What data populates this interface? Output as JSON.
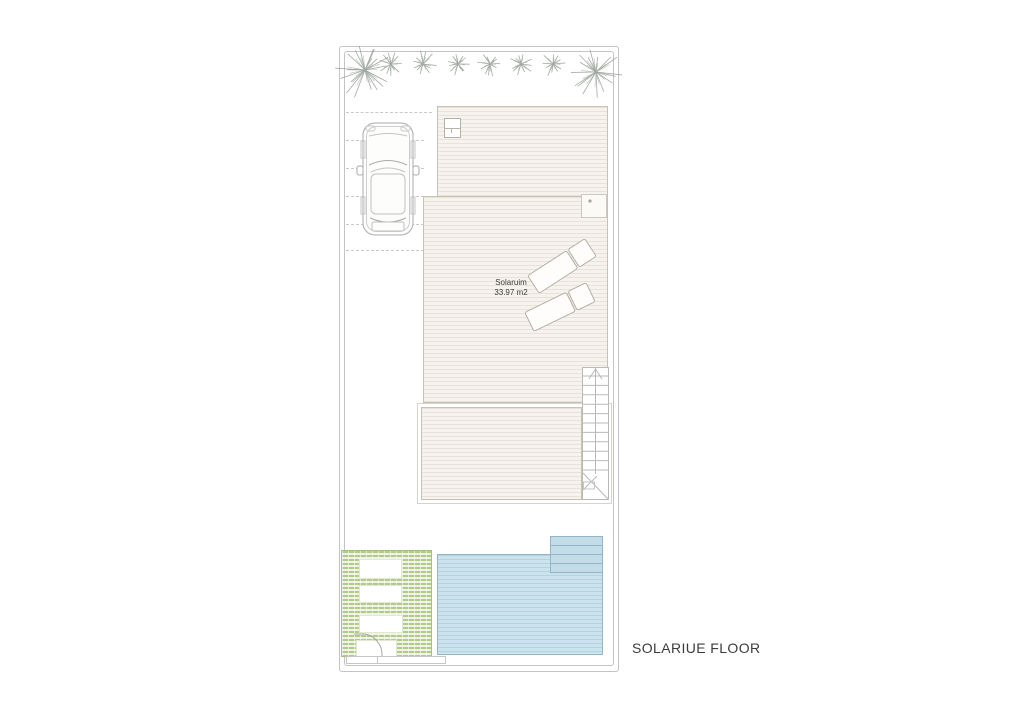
{
  "plan": {
    "floor_label": "SOLARIUE FLOOR",
    "solarium_label": {
      "line1": "Solaruim",
      "line2": "33.97 m2"
    }
  },
  "theme": {
    "boundary": "#c4c4c4",
    "wall": "#c6c2b8",
    "deck_fill": "#f6f3ee",
    "deck_line": "#e8e3d8",
    "pool_fill": "#cce2ec",
    "pool_line": "#b5d2e0",
    "pool_border": "#92b6c8",
    "pool_steps_fill": "#c3dce8",
    "planter_fill": "#eef3e4",
    "planter_line": "#b2ca8b",
    "planter_border": "#a5bf80",
    "furniture_stroke": "#b3afa6",
    "drawing_stroke": "#a6a6a6",
    "text_color": "#3c3c3c"
  },
  "icons": {
    "palm_tree": "radial starburst lines",
    "car": "car top-view outline",
    "sun_lounger": "lounger with backrest outline",
    "stair_direction": "chevron-up arrow",
    "door": "quarter-circle swing arc",
    "skylight": "small box with dot"
  }
}
